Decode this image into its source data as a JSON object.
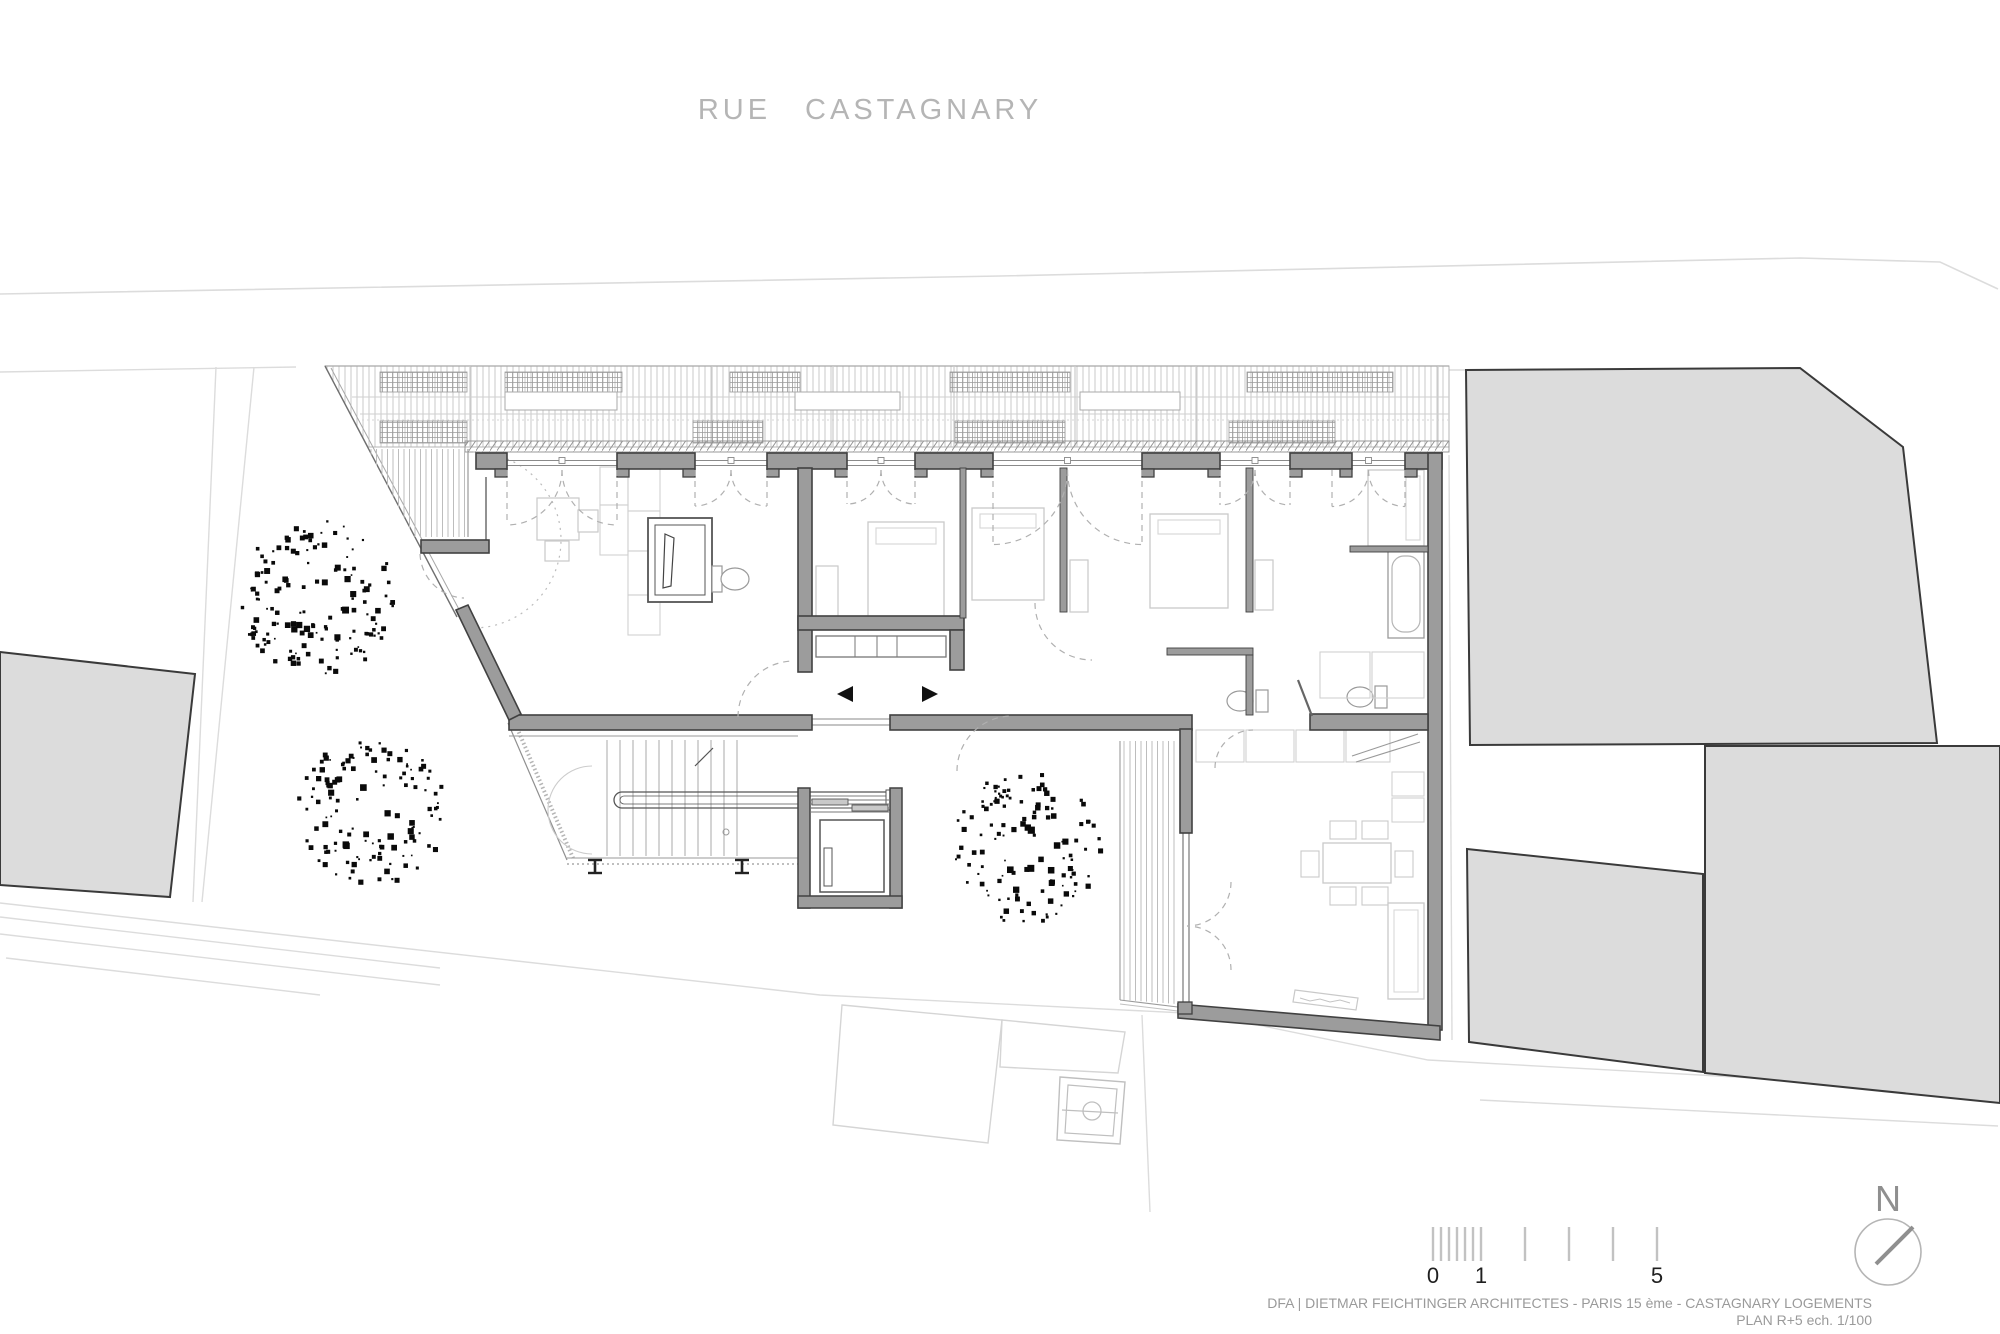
{
  "street": {
    "word1": "RUE",
    "word2": "CASTAGNARY"
  },
  "title_block": {
    "line1": "DFA | DIETMAR FEICHTINGER ARCHITECTES - PARIS 15 ème - CASTAGNARY LOGEMENTS",
    "line2": "PLAN R+5 ech. 1/100"
  },
  "scale_bar": {
    "label_0": "0",
    "label_1": "1",
    "label_5": "5"
  },
  "north_indicator": {
    "label": "N"
  },
  "colors": {
    "wall_gray": "#9c9c9c",
    "wall_outline": "#414141",
    "context_building_fill": "#dcdcdc",
    "context_building_outline": "#3a3a3a",
    "faint_line": "#dcdcdc",
    "hatch_line": "#c6c6c6",
    "dashed_line": "#b0b0b0",
    "thin_furniture_line": "#c9c9c9",
    "street_label_color": "#b5b5b5",
    "title_color": "#9a9a9a",
    "tree_color": "#0a0a0a"
  }
}
